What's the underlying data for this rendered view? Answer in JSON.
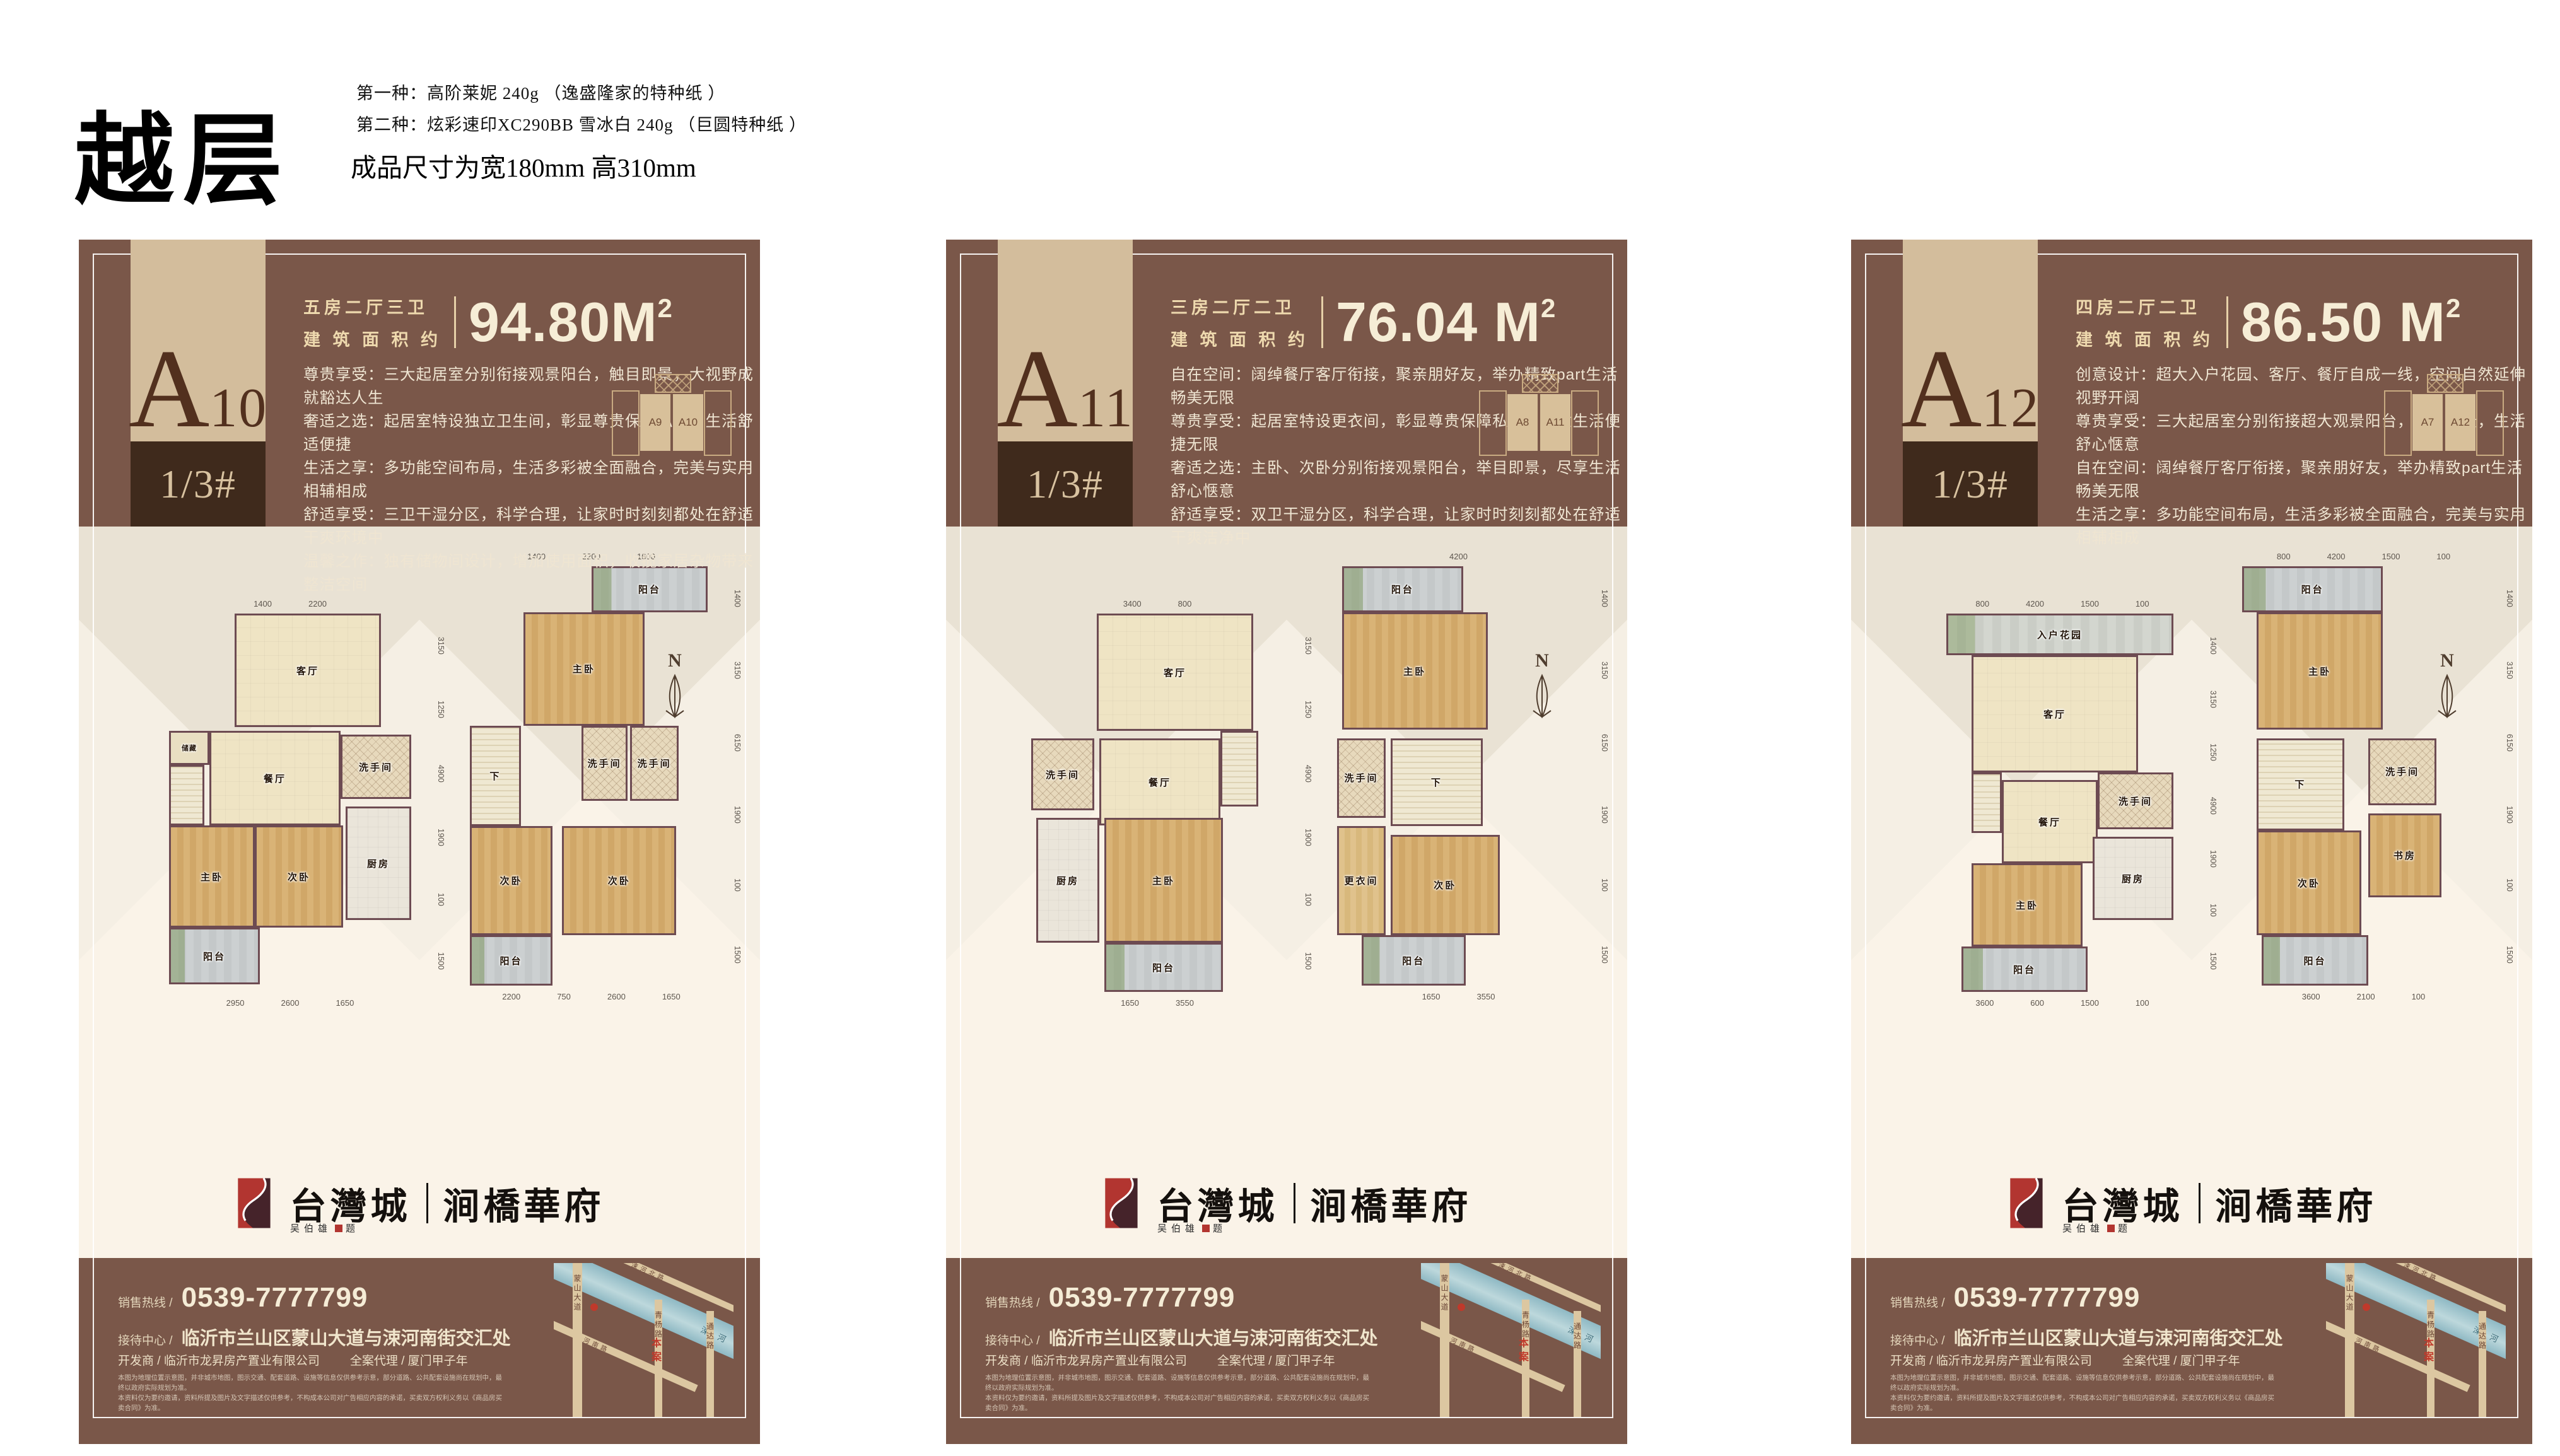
{
  "page": {
    "title": "越层",
    "spec_line1": "第一种：高阶莱妮 240g （逸盛隆家的特种纸 ）",
    "spec_line2": "第二种：炫彩速印XC290BB 雪冰白 240g （巨圆特种纸 ）",
    "size_note": "成品尺寸为宽180mm  高310mm"
  },
  "compass": "N",
  "brand": {
    "name_left": "台灣城",
    "name_right": "涧橋華府",
    "signature_name": "吴伯雄",
    "signature_suffix": "题"
  },
  "colors": {
    "card_brown": "#7a5749",
    "band_tan": "#d3bd9c",
    "band_dark": "#3f2a1c",
    "cream_text": "#f6edd6",
    "accent_red": "#b23530"
  },
  "footer": {
    "phone_label": "销售热线 /",
    "phone": "0539-7777799",
    "center_label": "接待中心 /",
    "address": "临沂市兰山区蒙山大道与涑河南街交汇处",
    "developer": "开发商 / 临沂市龙昇房产置业有限公司",
    "agency": "全案代理 / 厦门甲子年",
    "disclaimer1": "本图为地理位置示意图，并非城市地图，图示交通、配套道路、设施等信息仅供参考示意，部分道路、公共配套设施尚在规划中，最终以政府实际规划为准。",
    "disclaimer2": "本资料仅为要约邀请，资料所提及图片及文字描述仅供参考，不构成本公司对广告相应内容的承诺，买卖双方权利义务以《商品房买卖合同》为准。"
  },
  "map": {
    "road_v1": "蒙山大道",
    "road_v2": "青杨路",
    "road_v3": "通达路",
    "road_d1": "涑河北路",
    "road_d2": "涑河南路",
    "river": "涑河",
    "marker": "本案"
  },
  "cards": [
    {
      "unit": {
        "letter": "A",
        "number": "10",
        "floor": "1/3#"
      },
      "spec": {
        "rooms": "五房二厅三卫",
        "area_label": "建 筑 面 积 约",
        "area": "94.80M",
        "sup": "2"
      },
      "desc": [
        "尊贵享受：三大起居室分别衔接观景阳台，触目即景，大视野成就豁达人生",
        "奢适之选：起居室特设独立卫生间，彰显尊贵保障私密，生活舒适便捷",
        "生活之享：多功能空间布局，生活多彩被全面融合，完美与实用相辅相成",
        "舒适享受：三卫干湿分区，科学合理，让家时时刻刻都处在舒适干爽环境中",
        "温馨之作：独有储物间设计，增加使用面积，收揽家居杂物带来整洁空间"
      ],
      "diagram": {
        "left": "A9",
        "right": "A10"
      },
      "plans": [
        {
          "dims_top": [
            "1400",
            "2200"
          ],
          "dims_right": [
            "3150",
            "1250",
            "4900",
            "1900",
            "100",
            "1500"
          ],
          "dims_bottom": [
            "2950",
            "2600",
            "1650"
          ],
          "rooms": [
            {
              "t": "living",
              "label": "客厅",
              "x": 28,
              "y": 0,
              "w": 58,
              "h": 30
            },
            {
              "t": "storage",
              "label": "储藏",
              "x": 2,
              "y": 31,
              "w": 16,
              "h": 9
            },
            {
              "t": "stairs",
              "label": "",
              "x": 2,
              "y": 40,
              "w": 14,
              "h": 16
            },
            {
              "t": "dining",
              "label": "餐厅",
              "x": 18,
              "y": 31,
              "w": 52,
              "h": 25
            },
            {
              "t": "bath",
              "label": "洗手间",
              "x": 70,
              "y": 32,
              "w": 28,
              "h": 17
            },
            {
              "t": "kitchen",
              "label": "厨房",
              "x": 72,
              "y": 51,
              "w": 26,
              "h": 30
            },
            {
              "t": "bed",
              "label": "主卧",
              "x": 2,
              "y": 56,
              "w": 34,
              "h": 27
            },
            {
              "t": "bed",
              "label": "次卧",
              "x": 36,
              "y": 56,
              "w": 35,
              "h": 27
            },
            {
              "t": "balcony",
              "label": "阳台",
              "x": 2,
              "y": 83,
              "w": 36,
              "h": 15
            }
          ]
        },
        {
          "dims_top": [
            "1400",
            "2200",
            "1600"
          ],
          "dims_right": [
            "1400",
            "3150",
            "6150",
            "1900",
            "100",
            "1500"
          ],
          "dims_bottom": [
            "2200",
            "750",
            "2600",
            "1650"
          ],
          "rooms": [
            {
              "t": "balcony",
              "label": "阳台",
              "x": 50,
              "y": 0,
              "w": 48,
              "h": 11
            },
            {
              "t": "bed",
              "label": "主卧",
              "x": 22,
              "y": 11,
              "w": 50,
              "h": 27
            },
            {
              "t": "stairs",
              "label": "下",
              "x": 0,
              "y": 38,
              "w": 21,
              "h": 24
            },
            {
              "t": "bath",
              "label": "洗手间",
              "x": 46,
              "y": 38,
              "w": 19,
              "h": 18
            },
            {
              "t": "bath",
              "label": "洗手间",
              "x": 66,
              "y": 38,
              "w": 20,
              "h": 18
            },
            {
              "t": "bed",
              "label": "次卧",
              "x": 0,
              "y": 62,
              "w": 34,
              "h": 26
            },
            {
              "t": "bed",
              "label": "次卧",
              "x": 38,
              "y": 62,
              "w": 47,
              "h": 26
            },
            {
              "t": "balcony",
              "label": "阳台",
              "x": 0,
              "y": 88,
              "w": 34,
              "h": 12
            }
          ]
        }
      ]
    },
    {
      "unit": {
        "letter": "A",
        "number": "11",
        "floor": "1/3#"
      },
      "spec": {
        "rooms": "三房二厅二卫",
        "area_label": "建 筑 面 积 约",
        "area": "76.04 M",
        "sup": "2"
      },
      "desc": [
        "自在空间：阔绰餐厅客厅衔接，聚亲朋好友，举办精致part生活畅美无限",
        "尊贵享受：起居室特设更衣间，彰显尊贵保障私密，创意生活便捷无限",
        "奢适之选：主卧、次卧分别衔接观景阳台，举目即景，尽享生活舒心惬意",
        "舒适享受：双卫干湿分区，科学合理，让家时时刻刻都处在舒适干爽洁净中"
      ],
      "diagram": {
        "left": "A8",
        "right": "A11"
      },
      "plans": [
        {
          "dims_top": [
            "3400",
            "800"
          ],
          "dims_right": [
            "3150",
            "1250",
            "4900",
            "1900",
            "100",
            "1500"
          ],
          "dims_bottom": [
            "1650",
            "3550"
          ],
          "rooms": [
            {
              "t": "living",
              "label": "客厅",
              "x": 26,
              "y": 0,
              "w": 62,
              "h": 31
            },
            {
              "t": "bath",
              "label": "洗手间",
              "x": 0,
              "y": 33,
              "w": 25,
              "h": 19
            },
            {
              "t": "dining",
              "label": "餐厅",
              "x": 27,
              "y": 33,
              "w": 48,
              "h": 23
            },
            {
              "t": "stairs",
              "label": "",
              "x": 75,
              "y": 31,
              "w": 15,
              "h": 20
            },
            {
              "t": "kitchen",
              "label": "厨房",
              "x": 2,
              "y": 54,
              "w": 25,
              "h": 33
            },
            {
              "t": "bed",
              "label": "主卧",
              "x": 29,
              "y": 54,
              "w": 47,
              "h": 33
            },
            {
              "t": "balcony",
              "label": "阳台",
              "x": 29,
              "y": 87,
              "w": 47,
              "h": 13
            }
          ]
        },
        {
          "dims_top": [
            "4200"
          ],
          "dims_right": [
            "1400",
            "3150",
            "6150",
            "1900",
            "100",
            "1500"
          ],
          "dims_bottom": [
            "1650",
            "3550"
          ],
          "rooms": [
            {
              "t": "balcony",
              "label": "阳台",
              "x": 2,
              "y": 0,
              "w": 50,
              "h": 11
            },
            {
              "t": "bed",
              "label": "主卧",
              "x": 2,
              "y": 11,
              "w": 60,
              "h": 28
            },
            {
              "t": "bath",
              "label": "洗手间",
              "x": 0,
              "y": 41,
              "w": 20,
              "h": 19
            },
            {
              "t": "stairs",
              "label": "下",
              "x": 22,
              "y": 41,
              "w": 38,
              "h": 21
            },
            {
              "t": "closet",
              "label": "更衣间",
              "x": 0,
              "y": 62,
              "w": 20,
              "h": 26
            },
            {
              "t": "bed",
              "label": "次卧",
              "x": 22,
              "y": 64,
              "w": 45,
              "h": 24
            },
            {
              "t": "balcony",
              "label": "阳台",
              "x": 10,
              "y": 88,
              "w": 43,
              "h": 12
            }
          ]
        }
      ]
    },
    {
      "unit": {
        "letter": "A",
        "number": "12",
        "floor": "1/3#"
      },
      "spec": {
        "rooms": "四房二厅二卫",
        "area_label": "建 筑 面 积 约",
        "area": "86.50 M",
        "sup": "2"
      },
      "desc": [
        "创意设计：超大入户花园、客厅、餐厅自成一线，空间自然延伸视野开阔",
        "尊贵享受：三大起居室分别衔接超大观景阳台，触目即景，生活舒心惬意",
        "自在空间：阔绰餐厅客厅衔接，聚亲朋好友，举办精致part生活畅美无限",
        "生活之享：多功能空间布局，生活多彩被全面融合，完美与实用相辅相成"
      ],
      "diagram": {
        "left": "A7",
        "right": "A12"
      },
      "plans": [
        {
          "dims_top": [
            "800",
            "4200",
            "1500",
            "100"
          ],
          "dims_right": [
            "1400",
            "3150",
            "1250",
            "4900",
            "1900",
            "100",
            "1500"
          ],
          "dims_bottom": [
            "3600",
            "600",
            "1500",
            "100"
          ],
          "rooms": [
            {
              "t": "garden",
              "label": "入户花园",
              "x": 4,
              "y": 0,
              "w": 90,
              "h": 11
            },
            {
              "t": "living",
              "label": "客厅",
              "x": 14,
              "y": 11,
              "w": 66,
              "h": 31
            },
            {
              "t": "stairs",
              "label": "",
              "x": 14,
              "y": 42,
              "w": 12,
              "h": 16
            },
            {
              "t": "bath",
              "label": "洗手间",
              "x": 64,
              "y": 42,
              "w": 30,
              "h": 15
            },
            {
              "t": "dining",
              "label": "餐厅",
              "x": 26,
              "y": 44,
              "w": 38,
              "h": 22
            },
            {
              "t": "kitchen",
              "label": "厨房",
              "x": 62,
              "y": 59,
              "w": 32,
              "h": 22
            },
            {
              "t": "bed",
              "label": "主卧",
              "x": 14,
              "y": 66,
              "w": 44,
              "h": 22
            },
            {
              "t": "balcony",
              "label": "阳台",
              "x": 10,
              "y": 88,
              "w": 50,
              "h": 12
            }
          ]
        },
        {
          "dims_top": [
            "800",
            "4200",
            "1500",
            "100"
          ],
          "dims_right": [
            "1400",
            "3150",
            "6150",
            "1900",
            "100",
            "1500"
          ],
          "dims_bottom": [
            "3600",
            "2100",
            "100"
          ],
          "rooms": [
            {
              "t": "balcony",
              "label": "阳台",
              "x": 0,
              "y": 0,
              "w": 58,
              "h": 11
            },
            {
              "t": "bed",
              "label": "主卧",
              "x": 6,
              "y": 11,
              "w": 52,
              "h": 28
            },
            {
              "t": "stairs",
              "label": "下",
              "x": 6,
              "y": 41,
              "w": 36,
              "h": 22
            },
            {
              "t": "bath",
              "label": "洗手间",
              "x": 52,
              "y": 41,
              "w": 28,
              "h": 16
            },
            {
              "t": "study",
              "label": "书房",
              "x": 52,
              "y": 59,
              "w": 30,
              "h": 20
            },
            {
              "t": "bed",
              "label": "次卧",
              "x": 6,
              "y": 63,
              "w": 43,
              "h": 25
            },
            {
              "t": "balcony",
              "label": "阳台",
              "x": 8,
              "y": 88,
              "w": 44,
              "h": 12
            }
          ]
        }
      ]
    }
  ]
}
